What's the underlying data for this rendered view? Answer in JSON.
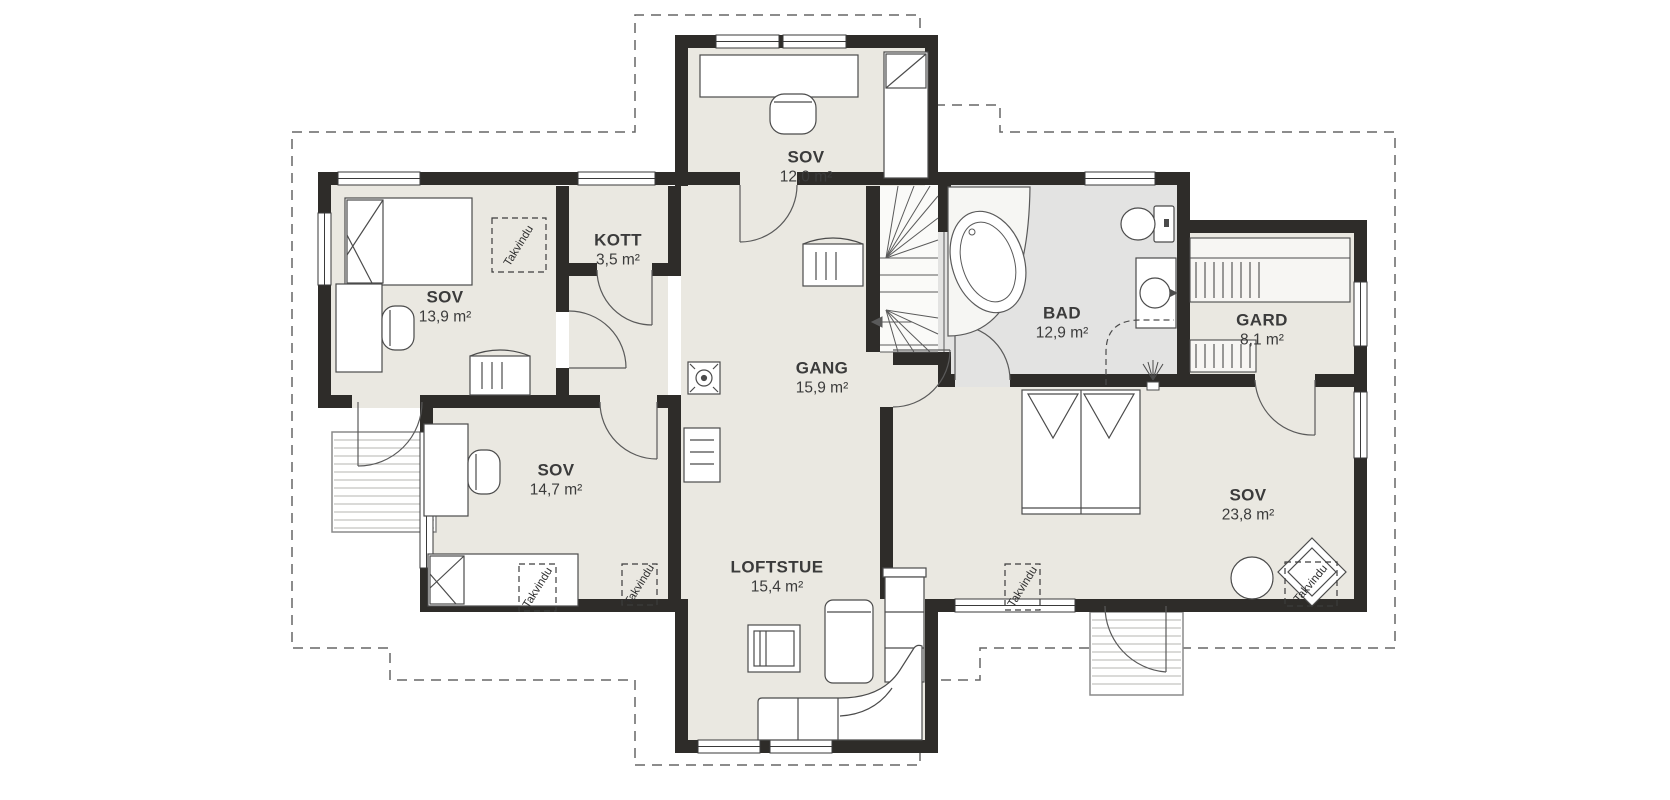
{
  "labels": {
    "roof_window": "Takvindu"
  },
  "rooms": [
    {
      "id": "sov-top",
      "name": "SOV",
      "area": "12,0 m²"
    },
    {
      "id": "kott",
      "name": "KOTT",
      "area": "3,5 m²"
    },
    {
      "id": "sov-left",
      "name": "SOV",
      "area": "13,9 m²"
    },
    {
      "id": "gang",
      "name": "GANG",
      "area": "15,9 m²"
    },
    {
      "id": "bad",
      "name": "BAD",
      "area": "12,9 m²"
    },
    {
      "id": "gard",
      "name": "GARD",
      "area": "8,1 m²"
    },
    {
      "id": "sov-middle",
      "name": "SOV",
      "area": "14,7 m²"
    },
    {
      "id": "sov-right",
      "name": "SOV",
      "area": "23,8 m²"
    },
    {
      "id": "loftstue",
      "name": "LOFTSTUE",
      "area": "15,4 m²"
    }
  ],
  "palette": {
    "wall": "#2e2c29",
    "floor": "#eae8e1",
    "bad_floor": "#e3e3e2",
    "furniture_outline": "#4b4b4b",
    "roof_dash": "#666666",
    "text": "#3b3b3b"
  }
}
